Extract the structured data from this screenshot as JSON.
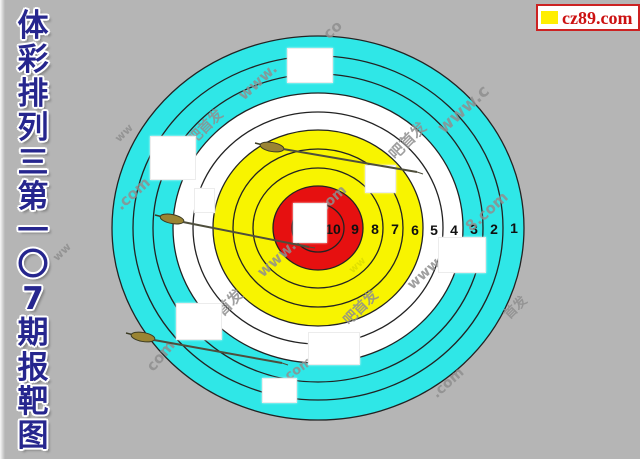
{
  "title": {
    "text": "体彩排列三第一〇7期报靶图",
    "chars": [
      "体",
      "彩",
      "排",
      "列",
      "三",
      "第",
      "一",
      "〇",
      "7",
      "期",
      "报",
      "靶",
      "图"
    ]
  },
  "banner": {
    "site": "cz89.com",
    "bullet_color": "#ffee00",
    "accent_color": "#cc1111"
  },
  "target": {
    "ring_numbers": [
      "10",
      "9",
      "8",
      "7",
      "6",
      "5",
      "4",
      "3",
      "2",
      "1"
    ],
    "colors": {
      "bullseye_red": "#e61010",
      "inner_yellow": "#f8f400",
      "middle_white": "#ffffff",
      "outer_cyan": "#2fe7e7",
      "ring_outline": "#222222"
    }
  },
  "watermarks": [
    "www.",
    "co",
    "www.c",
    "吧首发",
    "吧首发",
    ".com",
    "www.",
    "8.com",
    "首发",
    "吧首发",
    "www",
    "8.com",
    "com",
    "com",
    ".com",
    "首发",
    "ww",
    "ww",
    "ww"
  ]
}
